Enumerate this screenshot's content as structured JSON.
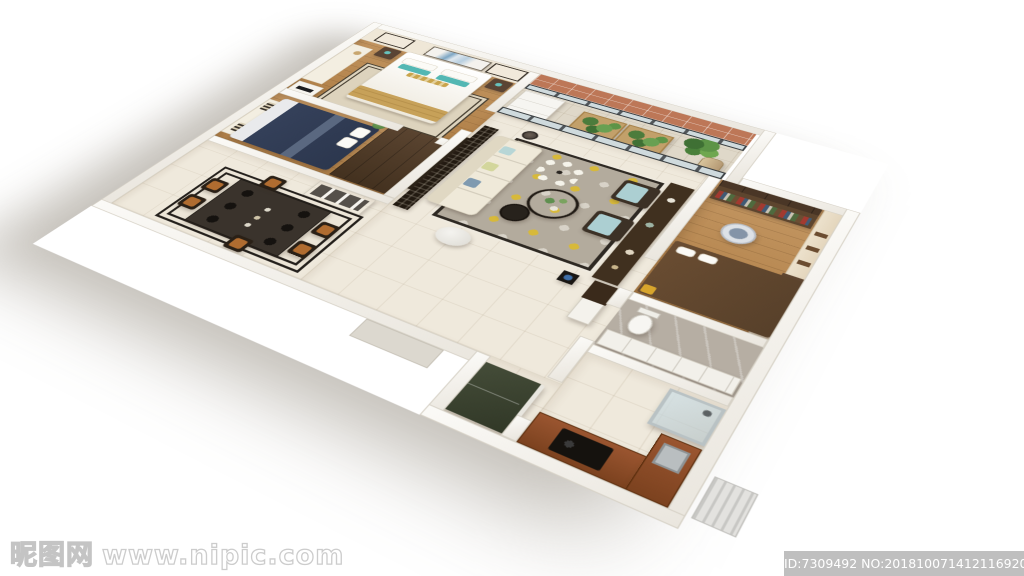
{
  "image_description": "Photorealistic 3D isometric cutaway rendering of a furnished two-bedroom apartment floor plan viewed from above",
  "watermark": {
    "logo_text": "昵图网",
    "site_url": "www.nipic.com"
  },
  "id_bar": {
    "text": "ID:7309492 NO:20181007141211692000"
  },
  "rooms": [
    "master-bedroom",
    "second-bedroom",
    "dining-area",
    "living-room",
    "balcony",
    "study",
    "bathroom",
    "kitchen",
    "hallway"
  ],
  "palette": {
    "background": "#ffffff",
    "wall": "#f8f6f2",
    "wood_floor": "#b98a57",
    "marble_floor": "#efe9dc",
    "bath_tile": "#b6aea3",
    "balcony_wall_terracotta": "#bd7757",
    "navy_bed": "#36425c",
    "teal_pillow": "#53b7b3",
    "tan_blanket": "#c7a159",
    "living_rug_gray": "#b3ab9d",
    "rug_accent_yellow": "#d7b93a",
    "dark_wood": "#4e3a28",
    "kitchen_counter": "#8a4a28",
    "fridge_olive": "#3a4130",
    "id_bar_gray": "#bababa"
  }
}
